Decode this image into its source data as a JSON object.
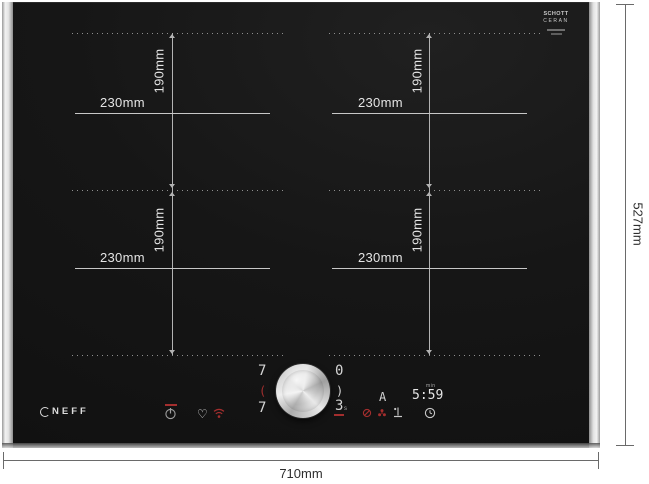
{
  "colors": {
    "glass_black": "#161616",
    "accent_red": "#a32e2e",
    "display_white": "#d4d4d4",
    "metal_trim": "#e3e3e3"
  },
  "logos": {
    "brand": "NEFF",
    "glass_brand_line1": "SCHOTT",
    "glass_brand_line2": "CERAN"
  },
  "dimensions": {
    "overall_width": "710mm",
    "overall_height": "527mm",
    "zones": [
      {
        "id": "top-left",
        "width": "230mm",
        "height": "190mm"
      },
      {
        "id": "top-right",
        "width": "230mm",
        "height": "190mm"
      },
      {
        "id": "bottom-left",
        "width": "230mm",
        "height": "190mm"
      },
      {
        "id": "bottom-right",
        "width": "230mm",
        "height": "190mm"
      }
    ]
  },
  "controls": {
    "zone_display_left_top": "7",
    "zone_selector_left": "(",
    "zone_display_left_bottom": "7",
    "zone_display_right_top": "0",
    "zone_selector_right": ")",
    "zone_display_right_bottom": "3",
    "zone_display_right_bottom_sub": "s",
    "mode_indicator": "A",
    "timer_value": "5:59",
    "timer_unit": "min",
    "icons": [
      "power",
      "favorite-heart",
      "wifi",
      "pan-detection",
      "vent-fan",
      "frying-sensor",
      "timer-clock"
    ]
  }
}
